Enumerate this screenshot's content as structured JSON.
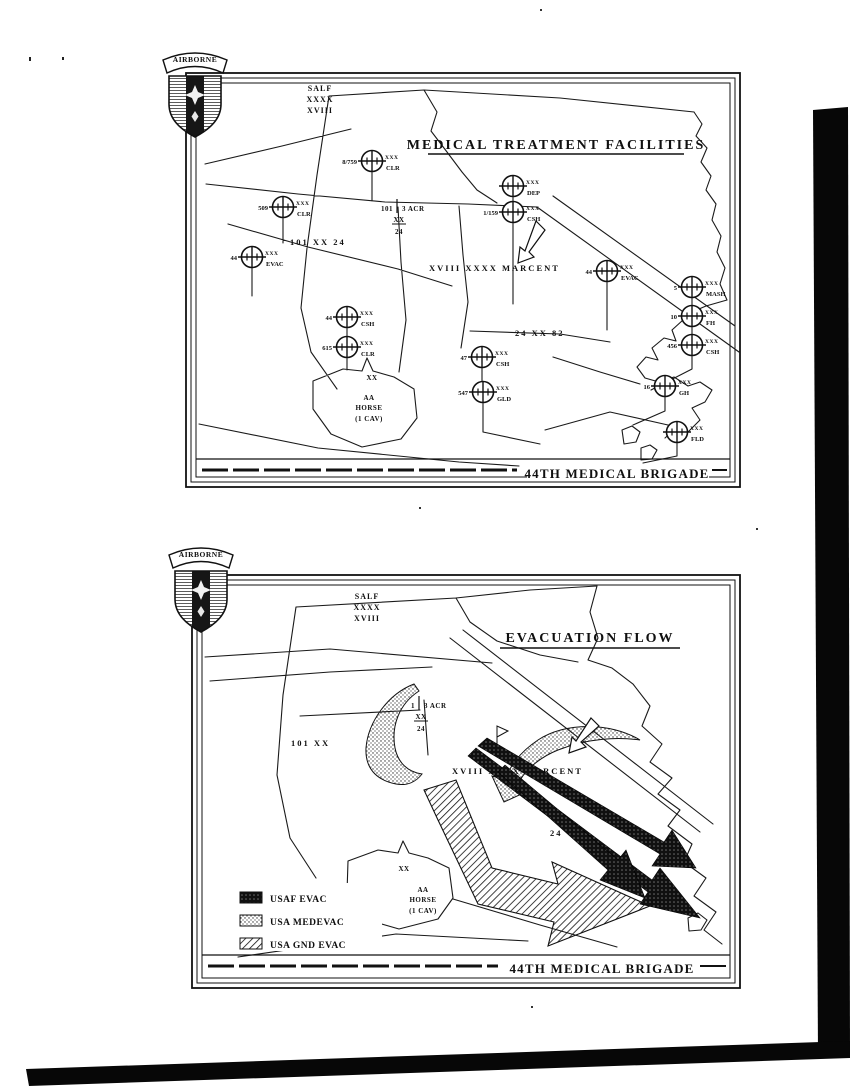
{
  "page": {
    "background": "#ffffff",
    "ink": "#111111"
  },
  "logo": {
    "banner": "AIRBORNE"
  },
  "map1": {
    "title": "MEDICAL TREATMENT FACILITIES",
    "footer": "44TH MEDICAL BRIGADE",
    "boundary": {
      "l1": "SALF",
      "l2": "XXXX",
      "l3": "XVIII"
    },
    "labels": {
      "acr_num": "101",
      "acr_unit": "3 ACR",
      "acr_xx": "XX",
      "acr_24": "24",
      "corps": "101 XX 24",
      "marcent": "XVIII XXXX MARCENT",
      "div82": "24 XX 82",
      "xx": "XX",
      "horse1": "AA",
      "horse2": "HORSE",
      "horse3": "(1 CAV)"
    },
    "facilities": [
      {
        "num": "8/759",
        "ech": "XXX",
        "type": "CLR"
      },
      {
        "num": "509",
        "ech": "XXX",
        "type": "CLR"
      },
      {
        "num": "44",
        "ech": "XXX",
        "type": "EVAC"
      },
      {
        "num": "44",
        "ech": "XXX",
        "type": "CSH"
      },
      {
        "num": "615",
        "ech": "XXX",
        "type": "CLR"
      },
      {
        "num": "",
        "ech": "XXX",
        "type": "DEP"
      },
      {
        "num": "1/159",
        "ech": "XXX",
        "type": "CSH"
      },
      {
        "num": "44",
        "ech": "XXX",
        "type": "EVAC"
      },
      {
        "num": "5",
        "ech": "XXX",
        "type": "MASH"
      },
      {
        "num": "10",
        "ech": "XXX",
        "type": "FH"
      },
      {
        "num": "456",
        "ech": "XXX",
        "type": "CSH"
      },
      {
        "num": "16",
        "ech": "XXX",
        "type": "GH"
      },
      {
        "num": "",
        "ech": "XXX",
        "type": "FLD"
      },
      {
        "num": "47",
        "ech": "XXX",
        "type": "CSH"
      },
      {
        "num": "547",
        "ech": "XXX",
        "type": "GLD"
      }
    ]
  },
  "map2": {
    "title": "EVACUATION FLOW",
    "footer": "44TH MEDICAL BRIGADE",
    "boundary": {
      "l1": "SALF",
      "l2": "XXXX",
      "l3": "XVIII"
    },
    "labels": {
      "acr_num": "1",
      "acr_unit": "3 ACR",
      "acr_xx": "XX",
      "acr_24": "24",
      "corps": "101 XX",
      "marcent": "XVIII XXXX MARCENT",
      "div": "24",
      "xx": "XX",
      "horse1": "AA",
      "horse2": "HORSE",
      "horse3": "(1 CAV)"
    },
    "legend": [
      {
        "label": "USAF EVAC",
        "pattern": "dark-crosshatch"
      },
      {
        "label": "USA MEDEVAC",
        "pattern": "stipple"
      },
      {
        "label": "USA GND EVAC",
        "pattern": "diagonal-hatch"
      }
    ]
  }
}
